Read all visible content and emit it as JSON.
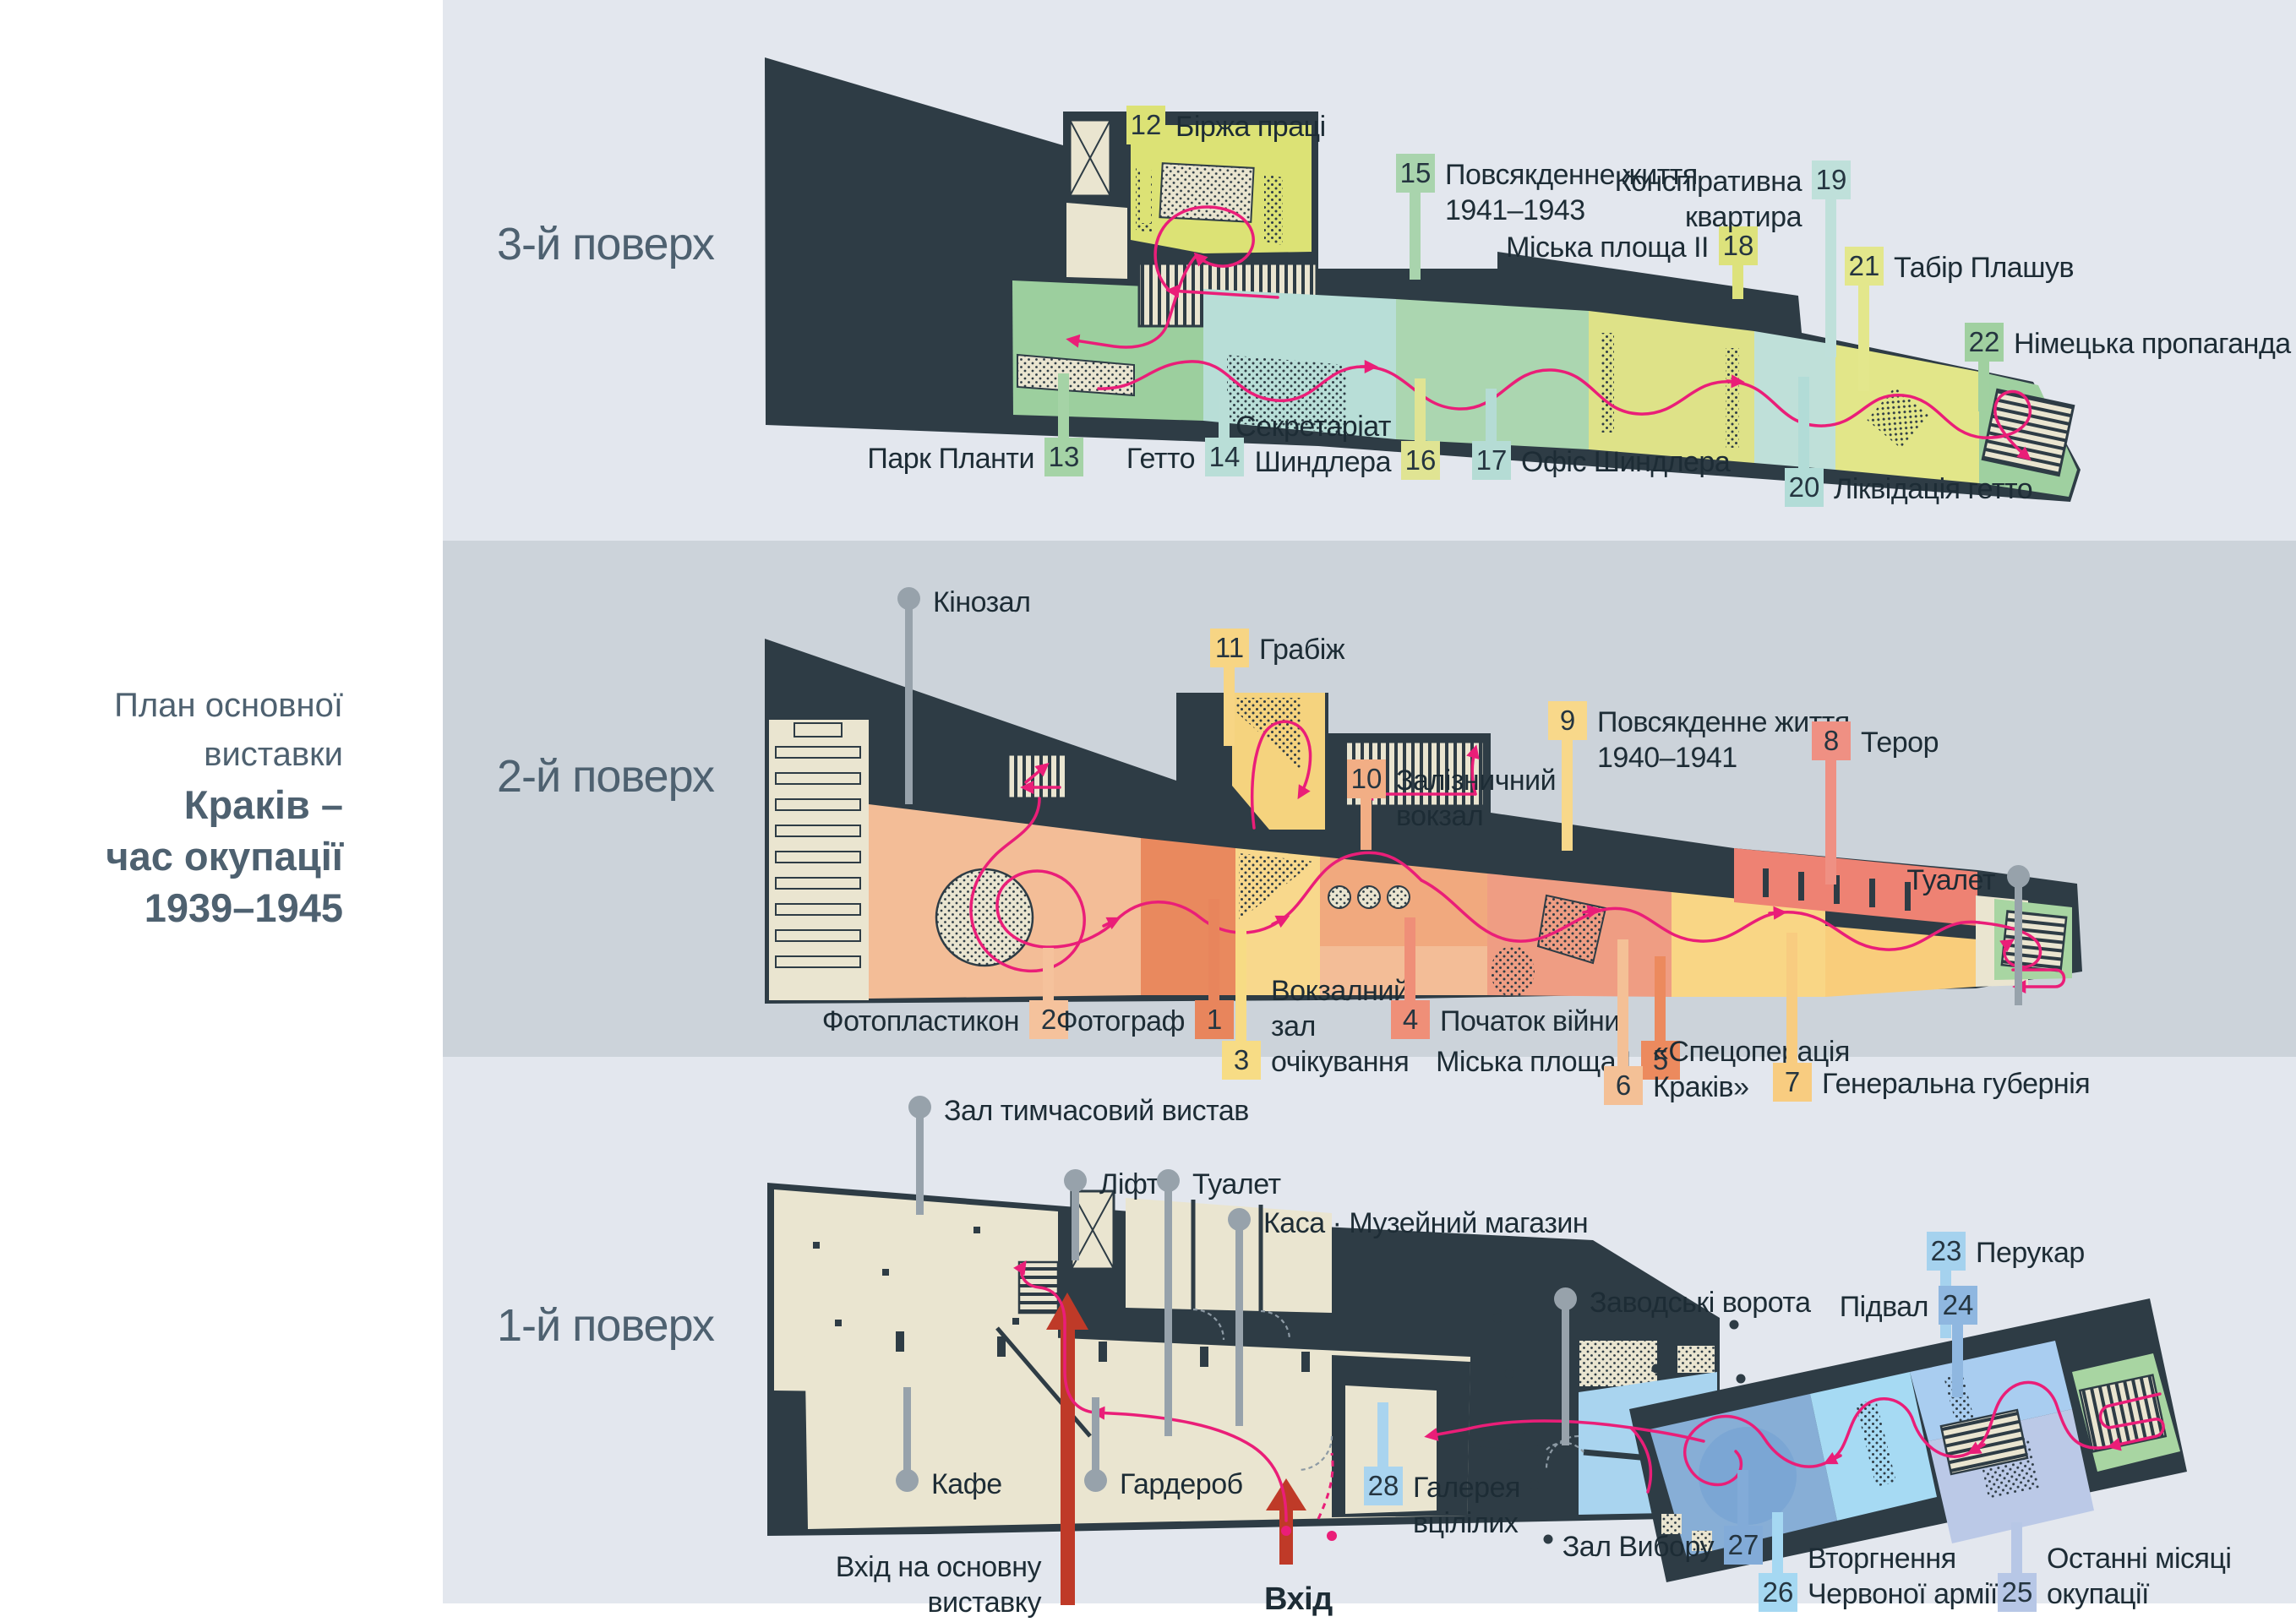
{
  "sidebar": {
    "subtitle": "План основної виставки",
    "title_line1": "Краків –",
    "title_line2": "час окупації",
    "title_line3": "1939–1945"
  },
  "colors": {
    "band_light": "#e3e7ee",
    "band_mid": "#ccd3da",
    "wall": "#2e3c45",
    "route": "#ea1e78",
    "pin": "#97a2ab",
    "entrance_arrow": "#bf3a28",
    "label_text": "#1d2c35",
    "heading_text": "#4e6170"
  },
  "f3": {
    "name": "3-й поверх",
    "labels": {
      "12": {
        "n": "12",
        "t": "Біржа праці",
        "c": "#dce275"
      },
      "13": {
        "n": "13",
        "t": "Парк Планти",
        "c": "#a5d3a6"
      },
      "14": {
        "n": "14",
        "t": "Гетто",
        "c": "#b9ded7"
      },
      "15": {
        "n": "15",
        "t": "Повсякденне життя\n1941–1943",
        "c": "#a9d4ad"
      },
      "16": {
        "n": "16",
        "t": "Секретаріат\nШиндлера",
        "c": "#e0e493"
      },
      "17": {
        "n": "17",
        "t": "Офіс Шиндлера",
        "c": "#b5dcd5"
      },
      "18": {
        "n": "18",
        "t": "Міська площа II",
        "c": "#dde27c"
      },
      "19": {
        "n": "19",
        "t": "Конспіративна\nквартира",
        "c": "#bfe0da"
      },
      "20": {
        "n": "20",
        "t": "Ліквідація гетто",
        "c": "#b2dcd7"
      },
      "21": {
        "n": "21",
        "t": "Табір Плашув",
        "c": "#e3e78c"
      },
      "22": {
        "n": "22",
        "t": "Німецька пропаганда",
        "c": "#a0d0a0"
      }
    }
  },
  "f2": {
    "name": "2-й поверх",
    "labels": {
      "1": {
        "n": "1",
        "t": "Фотограф",
        "c": "#e8855c"
      },
      "2": {
        "n": "2",
        "t": "Фотопластикон",
        "c": "#f5c29c"
      },
      "3": {
        "n": "3",
        "t": "Вокзалний\nзал\nочікування",
        "c": "#f7dc85"
      },
      "4": {
        "n": "4",
        "t": "Початок війни",
        "c": "#ef8f78"
      },
      "5": {
        "n": "5",
        "t": "Міська площа I",
        "c": "#ec8a5e"
      },
      "6": {
        "n": "6",
        "t": "«Спецоперація\nКраків»",
        "c": "#f4c096"
      },
      "7": {
        "n": "7",
        "t": "Генеральна губернія",
        "c": "#f8cc80"
      },
      "8": {
        "n": "8",
        "t": "Терор",
        "c": "#ef9083"
      },
      "9": {
        "n": "9",
        "t": "Повсякденне життя\n1940–1941",
        "c": "#f8d88a"
      },
      "10": {
        "n": "10",
        "t": "Залізничний\nвокзал",
        "c": "#f2ae85"
      },
      "11": {
        "n": "11",
        "t": "Грабіж",
        "c": "#f7d584"
      }
    },
    "pins": {
      "cinema": "Кінозал",
      "toilet": "Туалет"
    }
  },
  "f1": {
    "name": "1-й поверх",
    "labels": {
      "23": {
        "n": "23",
        "t": "Перукар",
        "c": "#a5d2ee"
      },
      "24": {
        "n": "24",
        "t": "Підвал",
        "c": "#8fb7e0"
      },
      "25": {
        "n": "25",
        "t": "Останні місяці\nокупації",
        "c": "#b7c7e6"
      },
      "26": {
        "n": "26",
        "t": "Вторгнення\nЧервоної армії",
        "c": "#a5d8f2"
      },
      "27": {
        "n": "27",
        "t": "Зал Вибору",
        "c": "#82abd8"
      },
      "28": {
        "n": "28",
        "t": "Галерея\nвцілілих",
        "c": "#a9d4ef"
      }
    },
    "pins": {
      "temp_hall": "Зал тимчасовий вистав",
      "lift": "Ліфт",
      "toilet": "Туалет",
      "kasa": "Каса · Музейний магазин",
      "gate": "Заводські ворота",
      "cafe": "Кафе",
      "wardrobe": "Гардероб"
    },
    "entrances": {
      "main": "Вхід на основну\nвиставку",
      "entry": "Вхід"
    }
  }
}
